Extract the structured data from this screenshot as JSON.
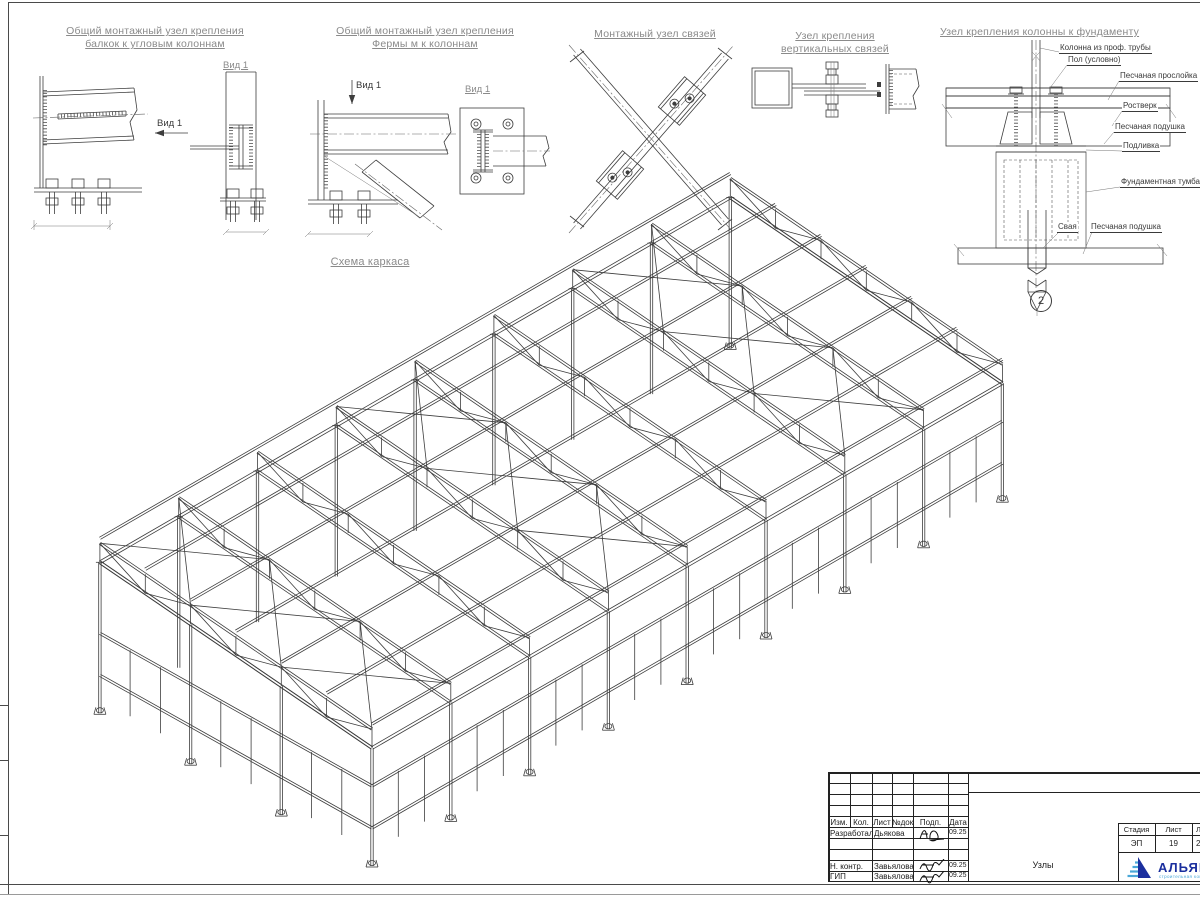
{
  "details": {
    "d1": {
      "title1": "Общий монтажный узел крепления",
      "title2": "балкок к угловым колоннам",
      "view_arrow_label": "Вид 1",
      "view_label": "Вид 1"
    },
    "d2": {
      "title1": "Общий монтажный узел крепления",
      "title2": "Фермы м к колоннам",
      "view_arrow_label": "Вид 1",
      "view_label": "Вид 1"
    },
    "d3": {
      "title": "Монтажный узел связей"
    },
    "d4": {
      "title1": "Узел крепления",
      "title2": "вертикальных связей"
    },
    "d5": {
      "title": "Узел крепления колонны к фундаменту",
      "labels": {
        "column": "Колонна из проф. трубы",
        "floor": "Пол (условно)",
        "sand_layer": "Песчаная прослойка",
        "rostverk": "Ростверк",
        "sand_pad_upper": "Песчаная подушка",
        "grout": "Подливка",
        "foundation_block": "Фундаментная тумба",
        "pile": "Свая",
        "sand_pad_lower": "Песчаная подушка"
      },
      "marker": "2"
    },
    "frame_scheme_title": "Схема каркаса"
  },
  "title_block": {
    "columns": [
      "Изм.",
      "Кол.",
      "Лист",
      "№док",
      "Подп.",
      "Дата"
    ],
    "rows": [
      {
        "role": "Разработал",
        "name": "Дьякова",
        "date": "09.25"
      },
      {
        "role": "Н. контр.",
        "name": "Завьялова",
        "date": "09.25"
      },
      {
        "role": "ГИП",
        "name": "Завьялова",
        "date": "09.25"
      }
    ],
    "doc_title": "Узлы",
    "stage_label": "Стадия",
    "sheet_label": "Лист",
    "sheets_label": "Листов",
    "stage": "ЭП",
    "sheet": "19",
    "sheets": "2",
    "company": "АЛЬЯНС",
    "company_sub": "строительная компания"
  },
  "colors": {
    "line": "#3d3d3d",
    "title_gray": "#8a8a8a",
    "logo_blue": "#1b2f9e",
    "logo_light": "#4aa8d8"
  }
}
